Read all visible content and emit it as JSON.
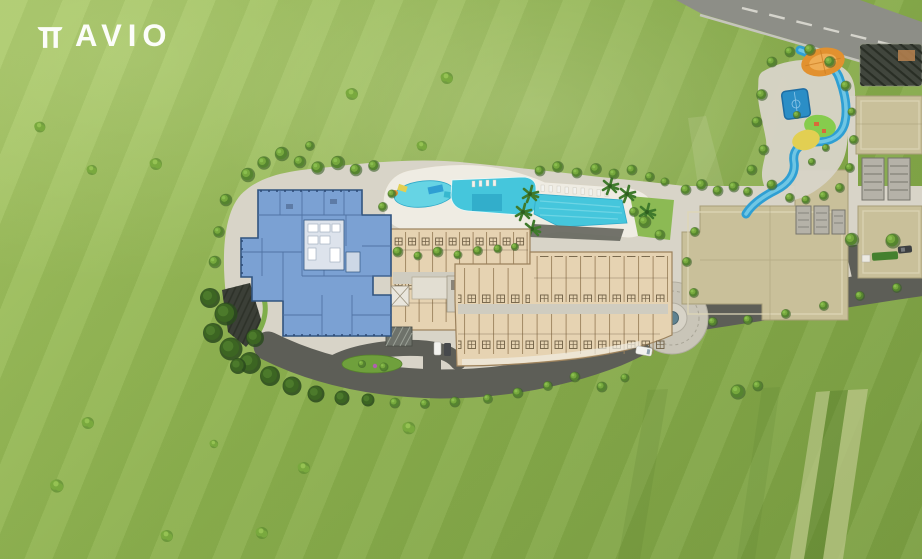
{
  "brand": {
    "name": "AVIO",
    "mark_glyph": "π"
  },
  "palette": {
    "grass_light": "#a8c766",
    "grass_base": "#8db14f",
    "grass_dark": "#7c9f43",
    "road_main": "#8d8e87",
    "road_dark": "#5d5e57",
    "road_line": "#dddcd4",
    "curb_light": "#c6c5bd",
    "path_light": "#d8d4c8",
    "deck_white": "#efece3",
    "building_blue": "#7ba1d3",
    "building_blue_dark": "#31547f",
    "building_blue_line": "#4c6f9e",
    "core_light": "#dde3ec",
    "beige_fill": "#e6d3b2",
    "beige_line": "#9b815c",
    "beige_dark": "#6f5f45",
    "corridor_grey": "#cfccc0",
    "podium_tan": "#c9c09a",
    "podium_edge": "#ddd6b6",
    "core_grey": "#b5b2a8",
    "core_grey_dark": "#76756c",
    "pergola_dark": "#41463d",
    "canopy_orange": "#e2912f",
    "court_blue": "#2b8ec6",
    "stream_blue": "#2f9fd3",
    "play_green": "#86cc4d",
    "play_yellow": "#e2cf52",
    "pool_water": "#45c6dc",
    "pool_deep": "#2fa9c8",
    "lap_deck_dark": "#6a6b63",
    "tree_dark": "#3a5f28",
    "tree_mid": "#55842f",
    "tree_light": "#76a83d",
    "tree_tip": "#8cc050",
    "tree_deep": "#2a4a1d",
    "tree_deep2": "#3c6522",
    "tree_deep3": "#4c7a2b",
    "bush_dark": "#5d8c31",
    "bush_mid": "#79a93e",
    "bush_light": "#95c253",
    "palm_green": "#3f7a2c",
    "island_green": "#6fa03c",
    "hedge_green": "#44802e",
    "car_white": "#f2f2ee",
    "car_dark": "#3c3f41",
    "logo_white": "#ffffff"
  }
}
